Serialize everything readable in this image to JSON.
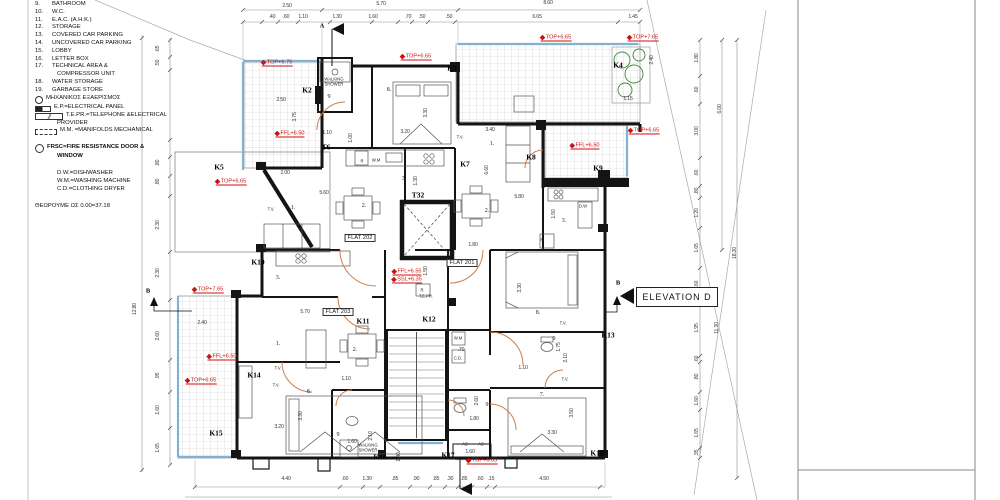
{
  "colors": {
    "wall": "#141414",
    "dim": "#3a3a3a",
    "red": "#cc1111",
    "window": "#7fb3d5",
    "door": "#c87e4f",
    "tile": "#c9c9c9",
    "plant": "#3a8a3a"
  },
  "elevation": {
    "label": "ELEVATION D"
  },
  "legend": {
    "rows": [
      {
        "n": "9.",
        "t": "BATHROOM"
      },
      {
        "n": "10.",
        "t": "W.C."
      },
      {
        "n": "11.",
        "t": "E.A.C. (A.H.K.)"
      },
      {
        "n": "12.",
        "t": "STORAGE"
      },
      {
        "n": "13.",
        "t": "COVERED CAR PARKING"
      },
      {
        "n": "14.",
        "t": "UNCOVERED CAR PARKING"
      },
      {
        "n": "15.",
        "t": "LOBBY"
      },
      {
        "n": "16.",
        "t": "LETTER BOX"
      },
      {
        "n": "17.",
        "t": "TECHNICAL AREA &"
      },
      {
        "t": "COMPRESSOR UNIT",
        "indent": true
      },
      {
        "n": "18.",
        "t": "WATER STORAGE"
      },
      {
        "n": "19.",
        "t": "GARBAGE STORE"
      },
      {
        "icon": "fan",
        "t": "ΜΗΧΑΝΙΚΟΣ ΕΞΑΕΡΙΣΜΟΣ"
      },
      {
        "icon": "ep",
        "t": "E.P.=ELECTRICAL PANEL"
      },
      {
        "icon": "tepr",
        "t": "T.E.PR.=TELEPHONE &ELECTRICAL"
      },
      {
        "t": "PROVIDER",
        "indent": true
      },
      {
        "icon": "mm",
        "t": "M.M. =MANIFOLDS MECHANICAL"
      },
      {
        "sp": 1,
        "t": ""
      },
      {
        "icon": "frsc",
        "t": "FRSC=FIRE RESISTANCE DOOR &",
        "b": 1
      },
      {
        "t": "WINDOW",
        "b": 1,
        "indent": true
      },
      {
        "sp": 1,
        "t": ""
      },
      {
        "t": "D.W.=DISHWASHER",
        "indent": true
      },
      {
        "t": "W.M.=WASHING MACHINE",
        "indent": true
      },
      {
        "t": "C.D.=CLOTHING DRYER",
        "indent": true
      },
      {
        "sp": 1,
        "t": ""
      },
      {
        "t": "ΘΕΩΡΟΥΜΕ ΩΣ 0.00=37.18"
      }
    ]
  },
  "plan": {
    "labels": [
      {
        "t": "2.50",
        "x": 287,
        "y": 6,
        "c": "dim"
      },
      {
        "t": "5.70",
        "x": 381,
        "y": 4,
        "c": "dim"
      },
      {
        "t": "8.60",
        "x": 548,
        "y": 3,
        "c": "dim"
      },
      {
        "t": ".40",
        "x": 272,
        "y": 17,
        "c": "dim"
      },
      {
        "t": ".60",
        "x": 286,
        "y": 17,
        "c": "dim"
      },
      {
        "t": "1.10",
        "x": 303,
        "y": 17,
        "c": "dim"
      },
      {
        "t": "1.30",
        "x": 337,
        "y": 17,
        "c": "dim"
      },
      {
        "t": "1.60",
        "x": 373,
        "y": 17,
        "c": "dim"
      },
      {
        "t": ".70",
        "x": 408,
        "y": 17,
        "c": "dim"
      },
      {
        "t": ".50",
        "x": 422,
        "y": 17,
        "c": "dim"
      },
      {
        "t": ".50",
        "x": 449,
        "y": 17,
        "c": "dim"
      },
      {
        "t": "6.65",
        "x": 537,
        "y": 17,
        "c": "dim"
      },
      {
        "t": "1.45",
        "x": 633,
        "y": 17,
        "c": "dim"
      },
      {
        "t": ".65",
        "x": 158,
        "y": 49,
        "c": "dim",
        "r": 1
      },
      {
        "t": ".50",
        "x": 158,
        "y": 63,
        "c": "dim",
        "r": 1
      },
      {
        "t": ".80",
        "x": 158,
        "y": 163,
        "c": "dim",
        "r": 1
      },
      {
        "t": ".80",
        "x": 158,
        "y": 182,
        "c": "dim",
        "r": 1
      },
      {
        "t": "2.30",
        "x": 158,
        "y": 225,
        "c": "dim",
        "r": 1
      },
      {
        "t": "2.30",
        "x": 158,
        "y": 273,
        "c": "dim",
        "r": 1
      },
      {
        "t": "2.60",
        "x": 158,
        "y": 336,
        "c": "dim",
        "r": 1
      },
      {
        "t": ".95",
        "x": 158,
        "y": 376,
        "c": "dim",
        "r": 1
      },
      {
        "t": "1.60",
        "x": 158,
        "y": 410,
        "c": "dim",
        "r": 1
      },
      {
        "t": "1.65",
        "x": 158,
        "y": 448,
        "c": "dim",
        "r": 1
      },
      {
        "t": "12.80",
        "x": 135,
        "y": 309,
        "c": "dim",
        "r": 1
      },
      {
        "t": "1.80",
        "x": 697,
        "y": 58,
        "c": "dim",
        "r": 1
      },
      {
        "t": ".60",
        "x": 697,
        "y": 90,
        "c": "dim",
        "r": 1
      },
      {
        "t": "3.00",
        "x": 697,
        "y": 131,
        "c": "dim",
        "r": 1
      },
      {
        "t": ".60",
        "x": 697,
        "y": 173,
        "c": "dim",
        "r": 1
      },
      {
        "t": ".80",
        "x": 697,
        "y": 191,
        "c": "dim",
        "r": 1
      },
      {
        "t": "1.20",
        "x": 697,
        "y": 213,
        "c": "dim",
        "r": 1
      },
      {
        "t": "1.65",
        "x": 697,
        "y": 248,
        "c": "dim",
        "r": 1
      },
      {
        "t": ".60",
        "x": 697,
        "y": 284,
        "c": "dim",
        "r": 1
      },
      {
        "t": "1.95",
        "x": 697,
        "y": 328,
        "c": "dim",
        "r": 1
      },
      {
        "t": ".60",
        "x": 697,
        "y": 359,
        "c": "dim",
        "r": 1
      },
      {
        "t": ".80",
        "x": 697,
        "y": 377,
        "c": "dim",
        "r": 1
      },
      {
        "t": "1.60",
        "x": 697,
        "y": 401,
        "c": "dim",
        "r": 1
      },
      {
        "t": "1.65",
        "x": 697,
        "y": 433,
        "c": "dim",
        "r": 1
      },
      {
        "t": ".35",
        "x": 697,
        "y": 453,
        "c": "dim",
        "r": 1
      },
      {
        "t": "6.00",
        "x": 720,
        "y": 109,
        "c": "dim",
        "r": 1
      },
      {
        "t": "18.20",
        "x": 735,
        "y": 253,
        "c": "dim",
        "r": 1
      },
      {
        "t": "11.30",
        "x": 717,
        "y": 328,
        "c": "dim",
        "r": 1
      },
      {
        "t": "4.40",
        "x": 286,
        "y": 479,
        "c": "dim"
      },
      {
        "t": ".60",
        "x": 345,
        "y": 479,
        "c": "dim"
      },
      {
        "t": "1.30",
        "x": 367,
        "y": 479,
        "c": "dim"
      },
      {
        "t": ".85",
        "x": 395,
        "y": 479,
        "c": "dim"
      },
      {
        "t": ".90",
        "x": 416,
        "y": 479,
        "c": "dim"
      },
      {
        "t": ".85",
        "x": 436,
        "y": 479,
        "c": "dim"
      },
      {
        "t": ".30",
        "x": 450,
        "y": 479,
        "c": "dim"
      },
      {
        "t": ".85",
        "x": 464,
        "y": 479,
        "c": "dim"
      },
      {
        "t": ".60",
        "x": 480,
        "y": 479,
        "c": "dim"
      },
      {
        "t": ".15",
        "x": 491,
        "y": 479,
        "c": "dim"
      },
      {
        "t": "4.50",
        "x": 544,
        "y": 479,
        "c": "dim"
      },
      {
        "t": "2.50",
        "x": 281,
        "y": 100,
        "c": "dim"
      },
      {
        "t": "3.75",
        "x": 295,
        "y": 117,
        "c": "dim",
        "r": 1
      },
      {
        "t": "1.10",
        "x": 327,
        "y": 133,
        "c": "dim"
      },
      {
        "t": "1.00",
        "x": 351,
        "y": 138,
        "c": "dim",
        "r": 1
      },
      {
        "t": "3.20",
        "x": 405,
        "y": 132,
        "c": "dim"
      },
      {
        "t": "3.30",
        "x": 426,
        "y": 113,
        "c": "dim",
        "r": 1
      },
      {
        "t": "2.00",
        "x": 285,
        "y": 173,
        "c": "dim"
      },
      {
        "t": "5.60",
        "x": 324,
        "y": 193,
        "c": "dim"
      },
      {
        "t": "1.30",
        "x": 416,
        "y": 181,
        "c": "dim",
        "r": 1
      },
      {
        "t": "3.40",
        "x": 490,
        "y": 130,
        "c": "dim"
      },
      {
        "t": "6.60",
        "x": 487,
        "y": 170,
        "c": "dim",
        "r": 1
      },
      {
        "t": "5.80",
        "x": 519,
        "y": 197,
        "c": "dim"
      },
      {
        "t": "1.50",
        "x": 554,
        "y": 214,
        "c": "dim",
        "r": 1
      },
      {
        "t": "1.80",
        "x": 473,
        "y": 245,
        "c": "dim"
      },
      {
        "t": "1.15",
        "x": 628,
        "y": 99,
        "c": "dim"
      },
      {
        "t": "2.40",
        "x": 652,
        "y": 60,
        "c": "dim",
        "r": 1
      },
      {
        "t": "1.50",
        "x": 426,
        "y": 271,
        "c": "dim",
        "r": 1
      },
      {
        "t": "2.40",
        "x": 202,
        "y": 323,
        "c": "dim"
      },
      {
        "t": "5.70",
        "x": 305,
        "y": 312,
        "c": "dim"
      },
      {
        "t": "1.10",
        "x": 346,
        "y": 379,
        "c": "dim"
      },
      {
        "t": "3.20",
        "x": 279,
        "y": 427,
        "c": "dim"
      },
      {
        "t": "3.30",
        "x": 301,
        "y": 416,
        "c": "dim",
        "r": 1
      },
      {
        "t": "2.10",
        "x": 371,
        "y": 436,
        "c": "dim",
        "r": 1
      },
      {
        "t": "1.60",
        "x": 352,
        "y": 442,
        "c": "dim"
      },
      {
        "t": "1.40",
        "x": 399,
        "y": 457,
        "c": "dim",
        "r": 1
      },
      {
        "t": ".70",
        "x": 461,
        "y": 350,
        "c": "dim"
      },
      {
        "t": "2.60",
        "x": 477,
        "y": 401,
        "c": "dim",
        "r": 1
      },
      {
        "t": "1.80",
        "x": 474,
        "y": 419,
        "c": "dim"
      },
      {
        "t": "1.10",
        "x": 523,
        "y": 368,
        "c": "dim"
      },
      {
        "t": "1.75",
        "x": 559,
        "y": 347,
        "c": "dim",
        "r": 1
      },
      {
        "t": "2.10",
        "x": 566,
        "y": 358,
        "c": "dim",
        "r": 1
      },
      {
        "t": "3.30",
        "x": 552,
        "y": 433,
        "c": "dim"
      },
      {
        "t": "3.50",
        "x": 572,
        "y": 413,
        "c": "dim",
        "r": 1
      },
      {
        "t": "3.30",
        "x": 520,
        "y": 288,
        "c": "dim",
        "r": 1
      },
      {
        "t": "1.60",
        "x": 470,
        "y": 452,
        "c": "dim"
      },
      {
        "t": "TOP+6.75",
        "x": 277,
        "y": 63,
        "c": "red"
      },
      {
        "t": "TOP+6.65",
        "x": 416,
        "y": 57,
        "c": "red"
      },
      {
        "t": "TOP+6.65",
        "x": 556,
        "y": 38,
        "c": "red"
      },
      {
        "t": "TOP+7.65",
        "x": 643,
        "y": 38,
        "c": "red"
      },
      {
        "t": "TOP+6.65",
        "x": 644,
        "y": 131,
        "c": "red"
      },
      {
        "t": "FFL+6.50",
        "x": 585,
        "y": 146,
        "c": "red"
      },
      {
        "t": "FFL+6.50",
        "x": 290,
        "y": 134,
        "c": "red"
      },
      {
        "t": "TOP+6.65",
        "x": 231,
        "y": 182,
        "c": "red"
      },
      {
        "t": "TOP+7.65",
        "x": 208,
        "y": 290,
        "c": "red"
      },
      {
        "t": "FFL+6.50",
        "x": 222,
        "y": 357,
        "c": "red"
      },
      {
        "t": "TOP+6.65",
        "x": 201,
        "y": 381,
        "c": "red"
      },
      {
        "t": "FFL+6.55",
        "x": 407,
        "y": 272,
        "c": "red"
      },
      {
        "t": "SSL+6.35",
        "x": 407,
        "y": 280,
        "c": "red"
      },
      {
        "t": "TOP+6.65",
        "x": 482,
        "y": 461,
        "c": "red"
      },
      {
        "t": "K2",
        "x": 307,
        "y": 90,
        "c": "k"
      },
      {
        "t": "K3",
        "x": 452,
        "y": 68,
        "c": "k"
      },
      {
        "t": "K4",
        "x": 618,
        "y": 65,
        "c": "k"
      },
      {
        "t": "K5",
        "x": 219,
        "y": 167,
        "c": "k"
      },
      {
        "t": "K7",
        "x": 465,
        "y": 164,
        "c": "k"
      },
      {
        "t": "K8",
        "x": 531,
        "y": 157,
        "c": "k"
      },
      {
        "t": "K9",
        "x": 598,
        "y": 168,
        "c": "k"
      },
      {
        "t": "K10",
        "x": 258,
        "y": 262,
        "c": "k"
      },
      {
        "t": "K11",
        "x": 363,
        "y": 321,
        "c": "k"
      },
      {
        "t": "K12",
        "x": 429,
        "y": 319,
        "c": "k"
      },
      {
        "t": "K13",
        "x": 608,
        "y": 335,
        "c": "k"
      },
      {
        "t": "K14",
        "x": 254,
        "y": 375,
        "c": "k"
      },
      {
        "t": "K15",
        "x": 216,
        "y": 433,
        "c": "k"
      },
      {
        "t": "K16",
        "x": 380,
        "y": 457,
        "c": "k"
      },
      {
        "t": "K17",
        "x": 448,
        "y": 455,
        "c": "k"
      },
      {
        "t": "K18",
        "x": 597,
        "y": 453,
        "c": "k"
      },
      {
        "t": "T6",
        "x": 326,
        "y": 147,
        "c": "k"
      },
      {
        "t": "T32",
        "x": 418,
        "y": 195,
        "c": "k"
      },
      {
        "t": "FLAT 202",
        "x": 360,
        "y": 238,
        "c": "flat"
      },
      {
        "t": "FLAT 201",
        "x": 462,
        "y": 263,
        "c": "flat"
      },
      {
        "t": "FLAT 203",
        "x": 338,
        "y": 312,
        "c": "flat"
      },
      {
        "t": "9",
        "x": 329,
        "y": 97,
        "c": "room"
      },
      {
        "t": "8.",
        "x": 389,
        "y": 90,
        "c": "room"
      },
      {
        "t": "1.",
        "x": 293,
        "y": 208,
        "c": "room"
      },
      {
        "t": "2.",
        "x": 364,
        "y": 206,
        "c": "room"
      },
      {
        "t": "3.",
        "x": 404,
        "y": 179,
        "c": "room"
      },
      {
        "t": "1.",
        "x": 492,
        "y": 144,
        "c": "room"
      },
      {
        "t": "2.",
        "x": 487,
        "y": 211,
        "c": "room"
      },
      {
        "t": "3.",
        "x": 564,
        "y": 221,
        "c": "room"
      },
      {
        "t": "3.",
        "x": 278,
        "y": 278,
        "c": "room"
      },
      {
        "t": "1.",
        "x": 278,
        "y": 344,
        "c": "room"
      },
      {
        "t": "2.",
        "x": 355,
        "y": 350,
        "c": "room"
      },
      {
        "t": "8.",
        "x": 309,
        "y": 392,
        "c": "room"
      },
      {
        "t": "9",
        "x": 338,
        "y": 435,
        "c": "room"
      },
      {
        "t": "8.",
        "x": 538,
        "y": 313,
        "c": "room"
      },
      {
        "t": "9",
        "x": 554,
        "y": 339,
        "c": "room"
      },
      {
        "t": "7.",
        "x": 542,
        "y": 395,
        "c": "room"
      },
      {
        "t": "9",
        "x": 487,
        "y": 405,
        "c": "room"
      },
      {
        "t": "WALKING\nSHOWER",
        "x": 334,
        "y": 82,
        "c": "fix"
      },
      {
        "t": "WALKING\nSHOWER",
        "x": 368,
        "y": 448,
        "c": "fix"
      },
      {
        "t": "T.V.",
        "x": 271,
        "y": 210,
        "c": "fix"
      },
      {
        "t": "T.V.",
        "x": 460,
        "y": 138,
        "c": "fix"
      },
      {
        "t": "T.V.",
        "x": 278,
        "y": 369,
        "c": "fix"
      },
      {
        "t": "T.V.",
        "x": 276,
        "y": 386,
        "c": "fix"
      },
      {
        "t": "T.V.",
        "x": 563,
        "y": 324,
        "c": "fix"
      },
      {
        "t": "T.V.",
        "x": 565,
        "y": 380,
        "c": "fix"
      },
      {
        "t": "R",
        "x": 362,
        "y": 162,
        "c": "fix"
      },
      {
        "t": "W.M",
        "x": 376,
        "y": 161,
        "c": "fix"
      },
      {
        "t": "R",
        "x": 542,
        "y": 241,
        "c": "fix"
      },
      {
        "t": "R",
        "x": 422,
        "y": 291,
        "c": "fix"
      },
      {
        "t": "D.W",
        "x": 583,
        "y": 207,
        "c": "fix"
      },
      {
        "t": "W.M",
        "x": 458,
        "y": 339,
        "c": "fix"
      },
      {
        "t": "C.D.",
        "x": 458,
        "y": 359,
        "c": "fix"
      },
      {
        "t": "AC",
        "x": 465,
        "y": 445,
        "c": "fix"
      },
      {
        "t": "AC",
        "x": 481,
        "y": 445,
        "c": "fix"
      },
      {
        "t": "T.E.PR.",
        "x": 426,
        "y": 297,
        "c": "fix"
      },
      {
        "t": "A",
        "x": 322,
        "y": 26,
        "c": "sec"
      },
      {
        "t": "B",
        "x": 148,
        "y": 291,
        "c": "sec"
      },
      {
        "t": "B",
        "x": 618,
        "y": 283,
        "c": "sec"
      }
    ]
  }
}
